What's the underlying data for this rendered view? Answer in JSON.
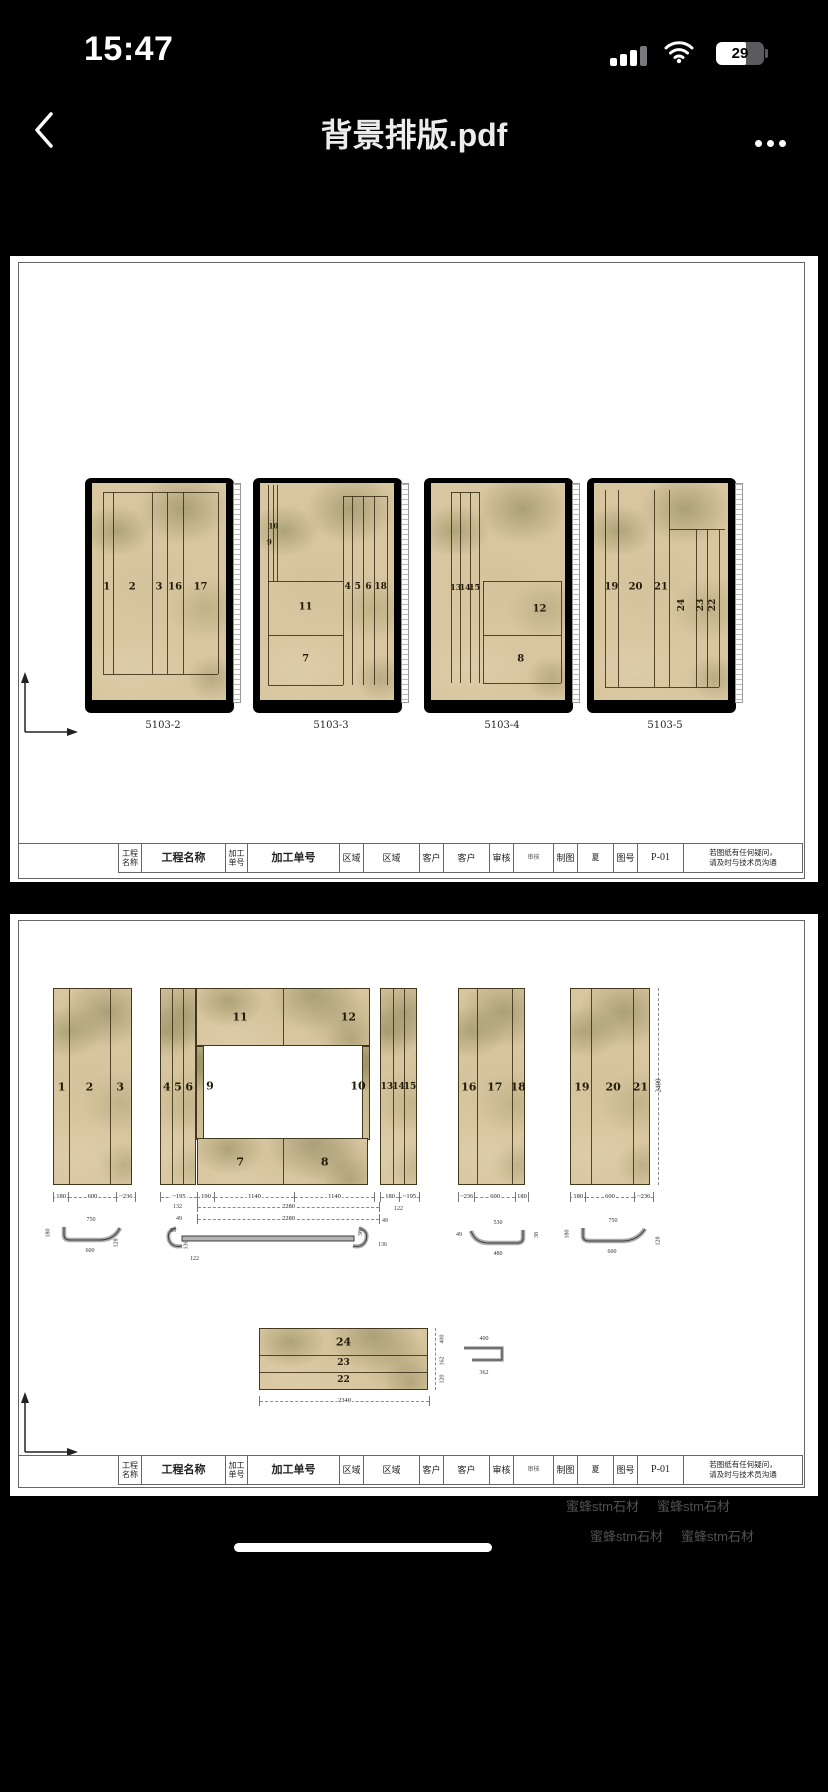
{
  "status": {
    "time": "15:47",
    "battery_percent": "29"
  },
  "nav": {
    "title": "背景排版.pdf"
  },
  "icons": {
    "back": "chevron-left",
    "more": "ellipsis",
    "wifi": "wifi-arcs",
    "cellular": "signal-bars",
    "battery": "battery-body",
    "axis": "origin-arrows"
  },
  "colors": {
    "app_bg": "#000000",
    "page_bg": "#ffffff",
    "marble_base": "#d8c6a0",
    "marble_vein": "#8b8658",
    "watermark": "#505050"
  },
  "watermark": {
    "text": "蜜蜂stm石材"
  },
  "p1": {
    "slabs": [
      {
        "caption": "5103-2",
        "pieces": [
          "1",
          "2",
          "3",
          "16",
          "17"
        ]
      },
      {
        "caption": "5103-3",
        "pieces": [
          "10",
          "9",
          "11",
          "7",
          "4",
          "5",
          "6",
          "18"
        ]
      },
      {
        "caption": "5103-4",
        "pieces": [
          "13",
          "14",
          "15",
          "12",
          "8"
        ]
      },
      {
        "caption": "5103-5",
        "pieces": [
          "19",
          "20",
          "21",
          "24",
          "23",
          "22"
        ]
      }
    ]
  },
  "tb": {
    "cells": [
      {
        "l": "工程名称",
        "v": "工程名称"
      },
      {
        "l": "加工单号",
        "v": "加工单号"
      },
      {
        "l": "区域",
        "v": "区域"
      },
      {
        "l": "客户",
        "v": "客户"
      },
      {
        "l": "审核",
        "v": "审核"
      },
      {
        "l": "制图",
        "v": "夏"
      },
      {
        "l": "图号",
        "v": "P-01"
      }
    ],
    "note1": "若图纸有任何疑问，",
    "note2": "请及时与技术员沟通"
  },
  "p2": {
    "gA": {
      "pieces": [
        "1",
        "2",
        "3"
      ],
      "dims": [
        "180",
        "600",
        "~236"
      ]
    },
    "gB": {
      "strips": [
        "4",
        "5",
        "6"
      ],
      "top": [
        "11",
        "12"
      ],
      "side": [
        "9",
        "10"
      ],
      "bottom": [
        "7",
        "8"
      ],
      "dims1": [
        "~195",
        "190",
        "1140",
        "1140"
      ],
      "d_132": "132",
      "d_2280a": "2280",
      "d_49": "49",
      "d_2280b": "2280",
      "endL": [
        "55",
        "136",
        "122"
      ],
      "endR": [
        "49",
        "38",
        "136"
      ]
    },
    "gC": {
      "pieces": [
        "13",
        "14",
        "15"
      ],
      "dims": [
        "180",
        "~195"
      ],
      "dim2": "122"
    },
    "gD": {
      "pieces": [
        "16",
        "17",
        "18"
      ],
      "dims": [
        "~236",
        "600",
        "180"
      ],
      "profile": {
        "top": "530",
        "bottom": "480",
        "left": "49",
        "right": "38"
      }
    },
    "gE": {
      "pieces": [
        "19",
        "20",
        "21"
      ],
      "dims": [
        "180",
        "600",
        "~236"
      ],
      "height": "2400",
      "profile": {
        "top": "750",
        "side": "180",
        "bottom": "600",
        "corner": "128"
      }
    },
    "profA": {
      "top": "750",
      "side": "180",
      "bottom": "600",
      "corner": "128"
    },
    "bottom": {
      "pieces": [
        "24",
        "23",
        "22"
      ],
      "width": "2340",
      "heights": [
        "400",
        "162",
        "120"
      ],
      "profile": {
        "top": "400",
        "bottom": "362"
      }
    }
  }
}
